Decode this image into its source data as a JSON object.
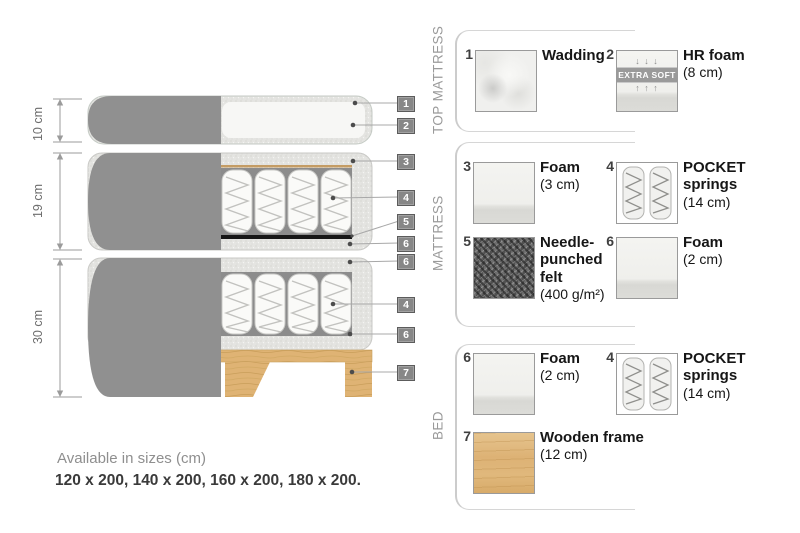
{
  "diagram": {
    "dimension_labels": [
      "10 cm",
      "19 cm",
      "30 cm"
    ],
    "callouts": [
      "1",
      "2",
      "3",
      "4",
      "5",
      "6",
      "6",
      "4",
      "6",
      "7"
    ]
  },
  "legend": {
    "sections": [
      {
        "title": "TOP MATTRESS",
        "items": [
          {
            "num": "1",
            "name": "Wadding",
            "size": ""
          },
          {
            "num": "2",
            "name": "HR foam",
            "size": "(8 cm)",
            "badge": "EXTRA SOFT",
            "arrows_down": "↓ ↓ ↓",
            "arrows_up": "↑ ↑ ↑"
          }
        ]
      },
      {
        "title": "MATTRESS",
        "items": [
          {
            "num": "3",
            "name": "Foam",
            "size": "(3 cm)"
          },
          {
            "num": "4",
            "name": "POCKET springs",
            "size": "(14 cm)"
          },
          {
            "num": "5",
            "name": "Needle-punched felt",
            "size": "(400 g/m²)"
          },
          {
            "num": "6",
            "name": "Foam",
            "size": "(2 cm)"
          }
        ]
      },
      {
        "title": "BED",
        "items": [
          {
            "num": "6",
            "name": "Foam",
            "size": "(2 cm)"
          },
          {
            "num": "4",
            "name": "POCKET springs",
            "size": "(14 cm)"
          },
          {
            "num": "7",
            "name": "Wooden frame",
            "size": "(12 cm)"
          }
        ]
      }
    ]
  },
  "footer": {
    "title": "Available in sizes (cm)",
    "sizes": "120 x 200, 140 x 200, 160 x 200, 180 x 200."
  },
  "colors": {
    "cover_gray": "#909090",
    "foam_speckle": "#e4e4e1",
    "wood": "#deb273",
    "callout_bg": "#878787",
    "felt": "#6e6e6e"
  }
}
